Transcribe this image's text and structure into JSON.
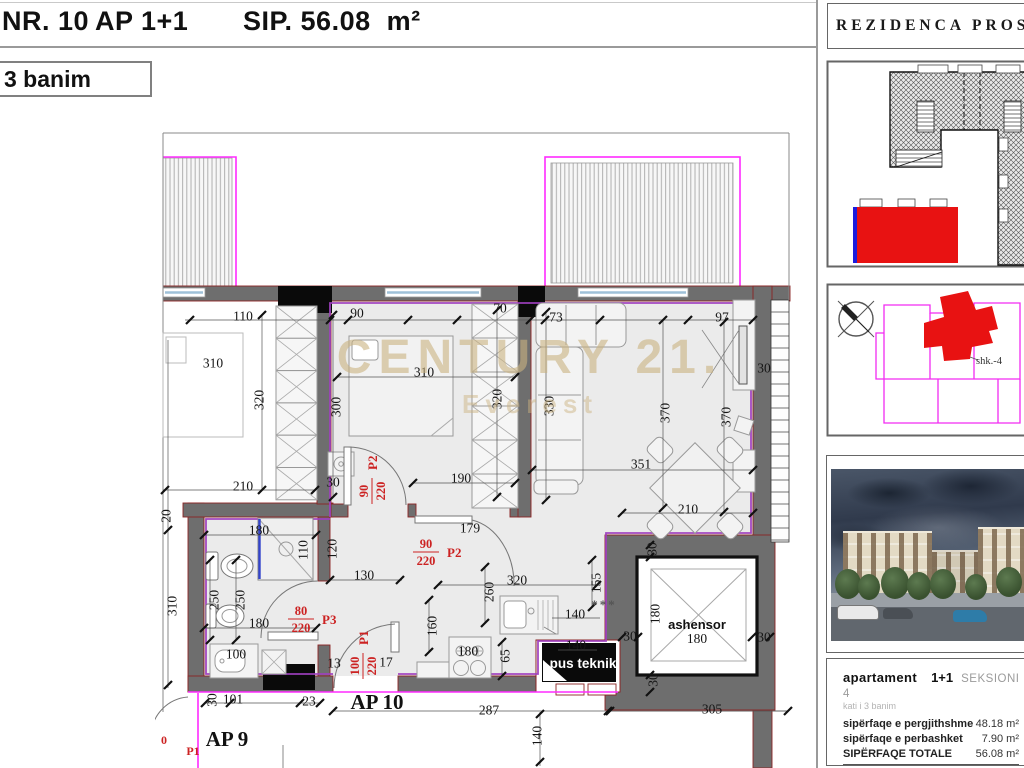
{
  "header": {
    "nr": "NR. 10",
    "type": "AP 1+1",
    "area": "SIP. 56.08  m²",
    "floor_box": "3 banim"
  },
  "watermark": {
    "line1": "CENTURY 21.",
    "line2": "Everest"
  },
  "floorplan": {
    "dimensions": [
      {
        "t": "110",
        "x": 243,
        "y": 316
      },
      {
        "t": "90",
        "x": 357,
        "y": 313
      },
      {
        "t": "70",
        "x": 500,
        "y": 308
      },
      {
        "t": "73",
        "x": 556,
        "y": 317
      },
      {
        "t": "97",
        "x": 722,
        "y": 317
      },
      {
        "t": "310",
        "x": 213,
        "y": 363
      },
      {
        "t": "310",
        "x": 424,
        "y": 372
      },
      {
        "t": "320",
        "x": 259,
        "y": 400,
        "r": -90
      },
      {
        "t": "300",
        "x": 336,
        "y": 407,
        "r": -90
      },
      {
        "t": "320",
        "x": 497,
        "y": 399,
        "r": -90
      },
      {
        "t": "330",
        "x": 549,
        "y": 406,
        "r": -90
      },
      {
        "t": "370",
        "x": 665,
        "y": 413,
        "r": -90
      },
      {
        "t": "370",
        "x": 726,
        "y": 417,
        "r": -90
      },
      {
        "t": "30",
        "x": 764,
        "y": 368
      },
      {
        "t": "210",
        "x": 243,
        "y": 486
      },
      {
        "t": "190",
        "x": 461,
        "y": 478
      },
      {
        "t": "351",
        "x": 641,
        "y": 464
      },
      {
        "t": "210",
        "x": 688,
        "y": 509
      },
      {
        "t": "30",
        "x": 333,
        "y": 482
      },
      {
        "t": "20",
        "x": 166,
        "y": 516,
        "r": -90
      },
      {
        "t": "180",
        "x": 259,
        "y": 530
      },
      {
        "t": "110",
        "x": 303,
        "y": 550,
        "r": -90
      },
      {
        "t": "120",
        "x": 332,
        "y": 549,
        "r": -90
      },
      {
        "t": "179",
        "x": 470,
        "y": 528
      },
      {
        "t": "130",
        "x": 364,
        "y": 575
      },
      {
        "t": "250",
        "x": 214,
        "y": 600,
        "r": -90
      },
      {
        "t": "250",
        "x": 240,
        "y": 600,
        "r": -90
      },
      {
        "t": "310",
        "x": 172,
        "y": 606,
        "r": -90
      },
      {
        "t": "320",
        "x": 517,
        "y": 580
      },
      {
        "t": "260",
        "x": 489,
        "y": 592,
        "r": -90
      },
      {
        "t": "155",
        "x": 596,
        "y": 583,
        "r": -90
      },
      {
        "t": "140",
        "x": 575,
        "y": 614
      },
      {
        "t": "180",
        "x": 259,
        "y": 623
      },
      {
        "t": "160",
        "x": 432,
        "y": 626,
        "r": -90
      },
      {
        "t": "180",
        "x": 468,
        "y": 651
      },
      {
        "t": "140",
        "x": 576,
        "y": 645
      },
      {
        "t": "65",
        "x": 505,
        "y": 656,
        "r": -90
      },
      {
        "t": "30",
        "x": 630,
        "y": 636
      },
      {
        "t": "100",
        "x": 236,
        "y": 654
      },
      {
        "t": "13",
        "x": 334,
        "y": 663
      },
      {
        "t": "17",
        "x": 386,
        "y": 662
      },
      {
        "t": "101",
        "x": 233,
        "y": 699
      },
      {
        "t": "30",
        "x": 212,
        "y": 700,
        "r": -90
      },
      {
        "t": "23",
        "x": 309,
        "y": 701
      },
      {
        "t": "287",
        "x": 489,
        "y": 710
      },
      {
        "t": "140",
        "x": 537,
        "y": 736,
        "r": -90
      },
      {
        "t": "305",
        "x": 712,
        "y": 709
      },
      {
        "t": "30",
        "x": 652,
        "y": 549,
        "r": -90
      },
      {
        "t": "180",
        "x": 655,
        "y": 614,
        "r": -90
      },
      {
        "t": "30",
        "x": 764,
        "y": 637
      },
      {
        "t": "30",
        "x": 653,
        "y": 680,
        "r": -90
      }
    ],
    "doors": [
      {
        "num": "90",
        "den": "220",
        "name": "P2",
        "x": 371,
        "y": 491,
        "rot": -90
      },
      {
        "num": "90",
        "den": "220",
        "name": "P2",
        "x": 426,
        "y": 551,
        "rot": 0
      },
      {
        "num": "80",
        "den": "220",
        "name": "P3",
        "x": 301,
        "y": 618,
        "rot": 0
      },
      {
        "num": "100",
        "den": "220",
        "name": "P1",
        "x": 362,
        "y": 666,
        "rot": -90
      }
    ],
    "labels": [
      {
        "t": "ashensor",
        "x": 697,
        "y": 629,
        "c": "lbl-bold",
        "n": "elevator-label"
      },
      {
        "t": "180",
        "x": 697,
        "y": 643,
        "c": "dim",
        "n": "elevator-size-label"
      },
      {
        "t": "pus teknik",
        "x": 583,
        "y": 668,
        "c": "lbl-shaft",
        "n": "technical-shaft-label"
      },
      {
        "t": "AP 10",
        "x": 377,
        "y": 709,
        "c": "lbl-ap",
        "n": "apartment-label"
      },
      {
        "t": "AP 9",
        "x": 227,
        "y": 746,
        "c": "lbl-ap",
        "n": "neighbor-apartment-label"
      },
      {
        "t": "***",
        "x": 604,
        "y": 609,
        "c": "lbl-stars",
        "n": "stars-mark"
      },
      {
        "t": "0",
        "x": 164,
        "y": 744,
        "c": "lbl-red",
        "n": "edge-red-label"
      },
      {
        "t": "P1",
        "x": 193,
        "y": 755,
        "c": "lbl-red",
        "n": "edge-door-label"
      }
    ]
  },
  "sidebar": {
    "title": "REZIDENCA PROSP",
    "location": {
      "section_label": "shk.-4"
    },
    "info": {
      "type_label": "apartament",
      "type_value": "1+1",
      "section": "SEKSIONI 4",
      "floor_note": "kati i 3 banim",
      "rows": [
        {
          "label": "sipërfaqe e pergjithshme",
          "value": "48.18 m²"
        },
        {
          "label": "sipërfaqe e perbashket",
          "value": "7.90 m²"
        },
        {
          "label": "SIPËRFAQE TOTALE",
          "value": "56.08 m²"
        }
      ]
    }
  }
}
